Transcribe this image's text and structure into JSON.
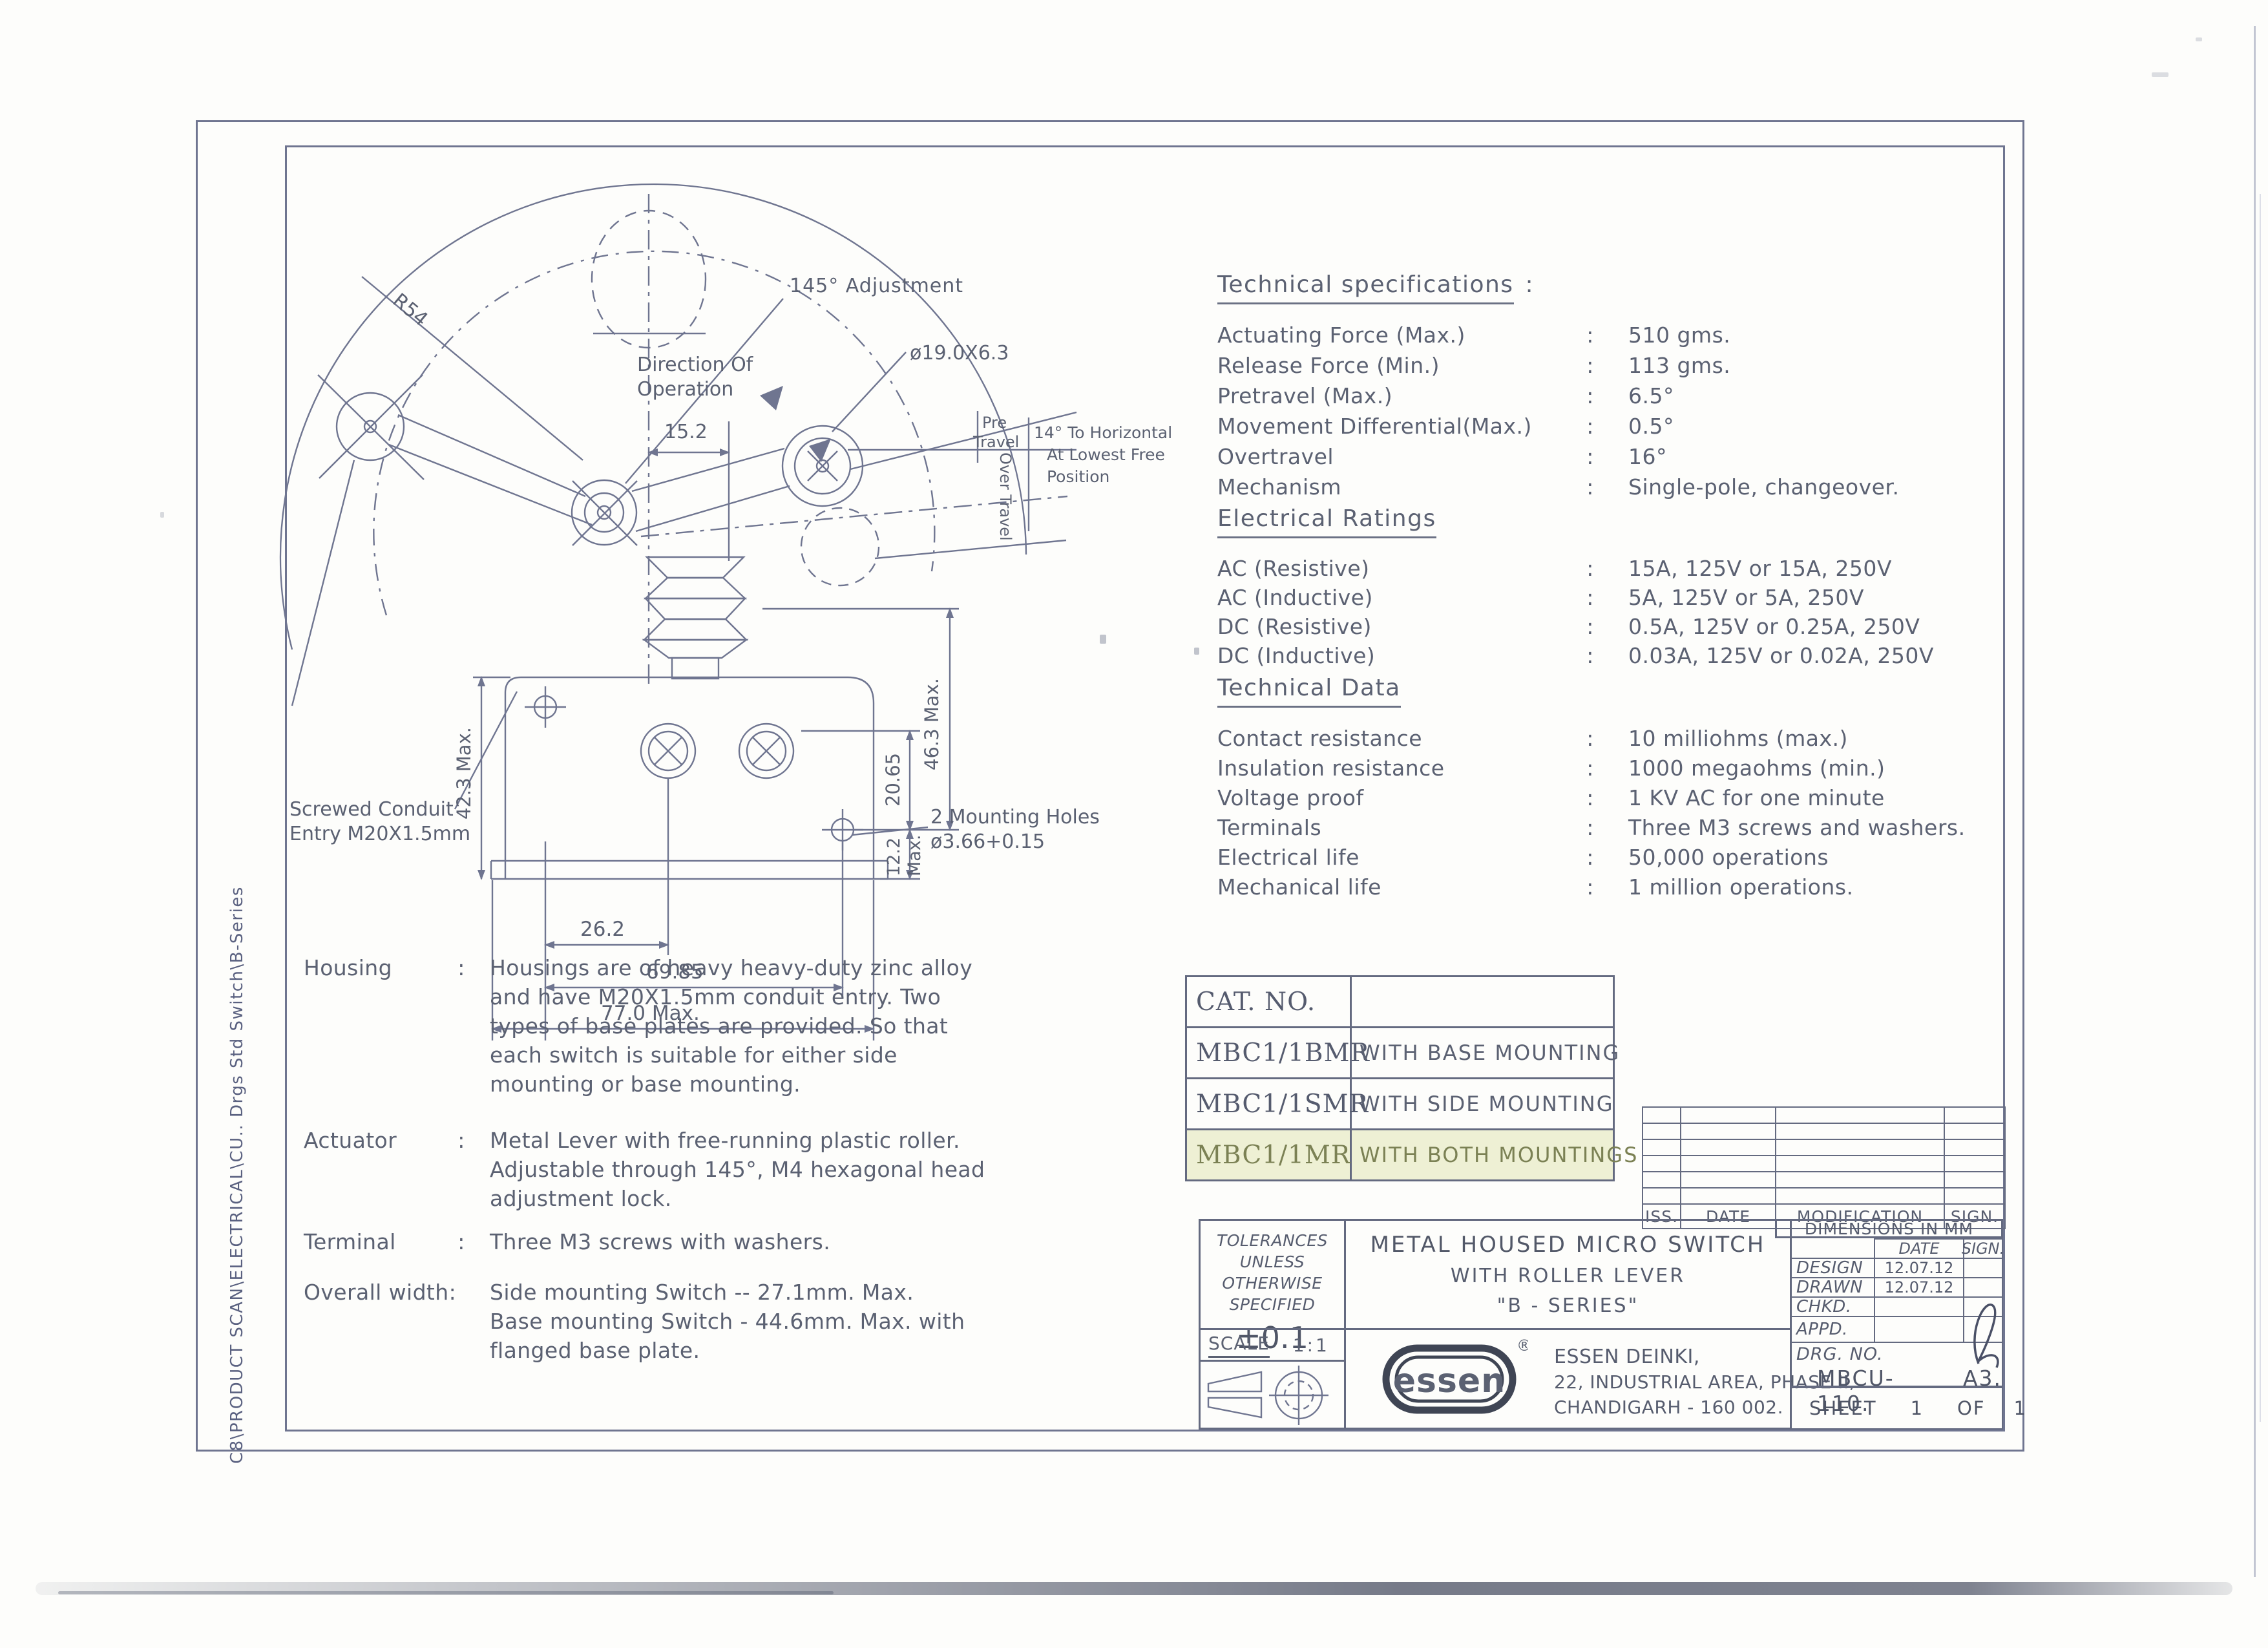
{
  "glyphs": {
    "colon": ":"
  },
  "drawing": {
    "labels": {
      "adjustment": "145° Adjustment",
      "direction_1": "Direction Of",
      "direction_2": "Operation",
      "radius": "R54",
      "roller_dia": "ø19.0X6.3",
      "dim_15_2": "15.2",
      "pre_travel_1": "Pre",
      "pre_travel_2": "Travel",
      "over_travel": "Over Travel",
      "horizontal_1": "14° To Horizontal",
      "horizontal_2": "At Lowest Free",
      "horizontal_3": "Position",
      "dim_42_3": "42.3 Max.",
      "dim_46_3": "46.3 Max.",
      "dim_20_65": "20.65",
      "dim_12_2a": "12.2",
      "dim_12_2b": "Max.",
      "dim_26_2": "26.2",
      "dim_69_85": "69.85",
      "dim_77": "77.0 Max.",
      "conduit_1": "Screwed Conduit",
      "conduit_2": "Entry M20X1.5mm",
      "holes_1": "2 Mounting Holes",
      "holes_2": "ø3.66+0.15"
    }
  },
  "specs": {
    "title": "Technical specifications",
    "rows": [
      {
        "label": "Actuating Force (Max.)",
        "value": "510 gms."
      },
      {
        "label": "Release Force (Min.)",
        "value": "113 gms."
      },
      {
        "label": "Pretravel (Max.)",
        "value": "6.5°"
      },
      {
        "label": "Movement Differential(Max.)",
        "value": "0.5°"
      },
      {
        "label": "Overtravel",
        "value": "16°"
      },
      {
        "label": "Mechanism",
        "value": "Single-pole, changeover."
      }
    ]
  },
  "electrical": {
    "title": "Electrical Ratings",
    "rows": [
      {
        "label": "AC (Resistive)",
        "value": "15A, 125V or 15A, 250V"
      },
      {
        "label": "AC (Inductive)",
        "value": "5A, 125V or 5A, 250V"
      },
      {
        "label": "DC (Resistive)",
        "value": "0.5A, 125V or 0.25A, 250V"
      },
      {
        "label": "DC (Inductive)",
        "value": "0.03A, 125V or 0.02A, 250V"
      }
    ]
  },
  "technical": {
    "title": "Technical Data",
    "rows": [
      {
        "label": "Contact resistance",
        "value": "10 milliohms (max.)"
      },
      {
        "label": "Insulation resistance",
        "value": "1000 megaohms (min.)"
      },
      {
        "label": "Voltage proof",
        "value": "1 KV AC for one minute"
      },
      {
        "label": "Terminals",
        "value": "Three M3 screws and washers."
      },
      {
        "label": "Electrical life",
        "value": "50,000 operations"
      },
      {
        "label": "Mechanical life",
        "value": "1 million operations."
      }
    ]
  },
  "notes": {
    "housing": {
      "label": "Housing",
      "lines": [
        "Housings are of heavy heavy-duty zinc alloy",
        "and have M20X1.5mm conduit entry. Two",
        "types of base plates  are provided. So that",
        "each switch is suitable for either side",
        "mounting or base mounting."
      ]
    },
    "actuator": {
      "label": "Actuator",
      "lines": [
        "Metal Lever with free-running plastic roller.",
        "Adjustable through 145°, M4 hexagonal head",
        "adjustment lock."
      ]
    },
    "terminal": {
      "label": "Terminal",
      "lines": [
        "Three M3 screws with washers."
      ]
    },
    "overall": {
      "label": "Overall width:",
      "lines": [
        "Side mounting Switch -- 27.1mm. Max.",
        "Base mounting Switch - 44.6mm. Max. with",
        "flanged base plate."
      ]
    }
  },
  "cat_table": {
    "header": "CAT. NO.",
    "highlight_color": "#eef0d4",
    "rows": [
      {
        "code": "MBC1/1BMR",
        "desc": "WITH BASE MOUNTING"
      },
      {
        "code": "MBC1/1SMR",
        "desc": "WITH SIDE MOUNTING"
      },
      {
        "code": "MBC1/1MR",
        "desc": "WITH BOTH MOUNTINGS"
      }
    ]
  },
  "revision": {
    "headers": [
      "ISS.",
      "DATE",
      "MODIFICATION",
      "SIGN."
    ]
  },
  "title_block": {
    "tolerances": {
      "l1": "TOLERANCES",
      "l2": "UNLESS",
      "l3": "OTHERWISE",
      "l4": "SPECIFIED",
      "value": "±0.1"
    },
    "title": {
      "l1": "METAL HOUSED MICRO SWITCH",
      "l2": "WITH ROLLER LEVER",
      "l3": "\"B - SERIES\""
    },
    "dims_note": "DIMENSIONS IN MM",
    "cols": {
      "date": "DATE",
      "sign": "SIGN."
    },
    "rows": [
      {
        "label": "DESIGN",
        "date": "12.07.12",
        "sign": ""
      },
      {
        "label": "DRAWN",
        "date": "12.07.12",
        "sign": ""
      },
      {
        "label": "CHKD.",
        "date": "",
        "sign": ""
      },
      {
        "label": "APPD.",
        "date": "",
        "sign": ""
      }
    ],
    "scale": {
      "label": "SCALE",
      "value": "1:1"
    },
    "company": {
      "logo": "essen",
      "reg": "®",
      "l1": "ESSEN DEINKI,",
      "l2": "22, INDUSTRIAL AREA, PHASE II,",
      "l3": "CHANDIGARH - 160 002."
    },
    "drg": {
      "label": "DRG. NO.",
      "value": "MBCU-110.",
      "size": "A3."
    },
    "sheet": {
      "label": "SHEET",
      "n1": "1",
      "of": "OF",
      "n2": "1"
    }
  },
  "side_note": "C8\\PRODUCT SCAN\\ELECTRICAL\\CU.. Drgs Std Switch\\B-Series"
}
